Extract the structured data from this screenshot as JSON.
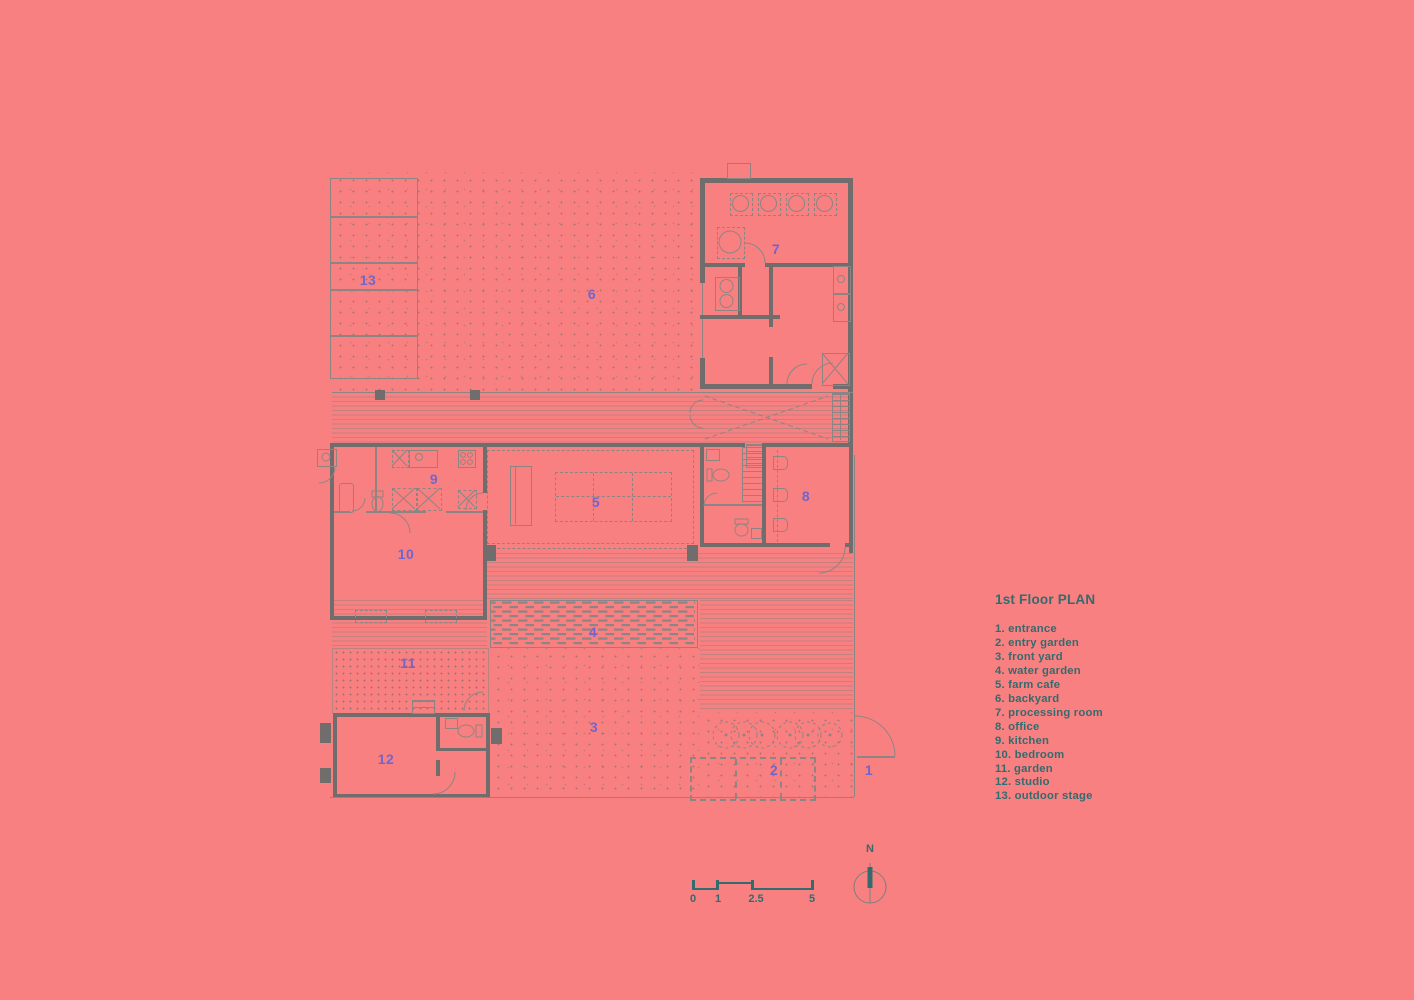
{
  "colors": {
    "background": "#F98080",
    "line": "#8d8583",
    "wall": "#716d6c",
    "room_label": "#7265CA",
    "text_teal": "#336B6E"
  },
  "legend": {
    "title": "1st Floor PLAN",
    "items": [
      "1. entrance",
      "2. entry garden",
      "3. front yard",
      "4. water garden",
      "5. farm cafe",
      "6. backyard",
      "7. processing room",
      "8. office",
      "9. kitchen",
      "10. bedroom",
      "11. garden",
      "12. studio",
      "13. outdoor stage"
    ]
  },
  "rooms": {
    "r1": "1",
    "r2": "2",
    "r3": "3",
    "r4": "4",
    "r5": "5",
    "r6": "6",
    "r7": "7",
    "r8": "8",
    "r9": "9",
    "r10": "10",
    "r11": "11",
    "r12": "12",
    "r13": "13"
  },
  "scale_bar": {
    "labels": [
      "0",
      "1",
      "2.5",
      "5"
    ]
  },
  "north": {
    "label": "N"
  }
}
